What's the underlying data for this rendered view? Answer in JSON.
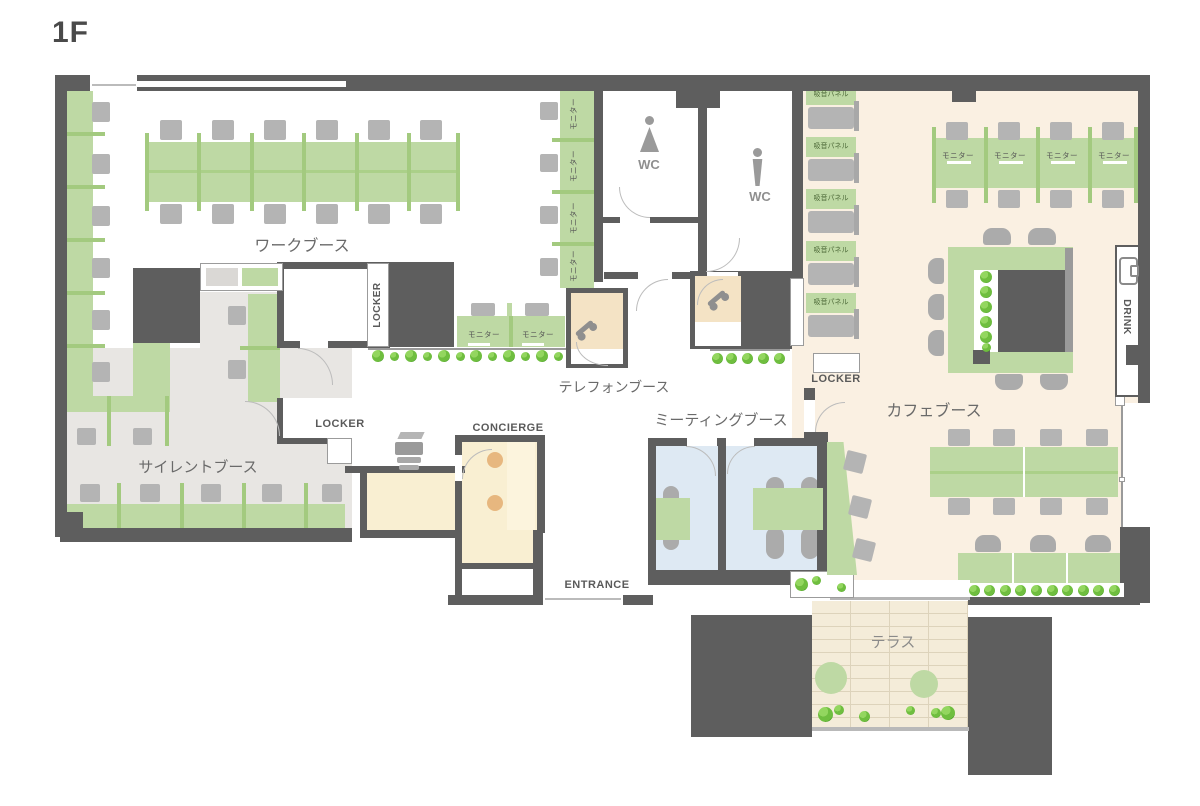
{
  "title": "1F",
  "labels": {
    "work_booth": "ワークブース",
    "silent_booth": "サイレントブース",
    "telephone_booth": "テレフォンブース",
    "meeting_booth": "ミーティングブース",
    "cafe_booth": "カフェブース",
    "terrace": "テラス",
    "locker": "LOCKER",
    "concierge": "CONCIERGE",
    "entrance": "ENTRANCE",
    "drink": "DRINK",
    "wc": "WC",
    "monitor": "モニター",
    "sound_panel": "吸音パネル"
  },
  "colors": {
    "wall": "#5e5e5e",
    "desk": "#bed9a4",
    "gline": "#a3ca7f",
    "glineLight": "#abd089",
    "chair": "#b4b4b4",
    "pill": "#ababab",
    "cafe": "#faf0e2",
    "silent": "#e8e6e3",
    "meet": "#dee9f3",
    "cream": "#f9efd2",
    "cream2": "#fcf4dd",
    "booth": "#f4e3c5",
    "terrace": "#f4ecd9",
    "terraceLine": "#ddd3bb",
    "plant": "#6fbe3f",
    "door": "#bcbcbc",
    "text": "#6a6a6a",
    "textDark": "#4a4a4a",
    "icon": "#9a9a9a",
    "grayBox": "#dad8d5"
  }
}
